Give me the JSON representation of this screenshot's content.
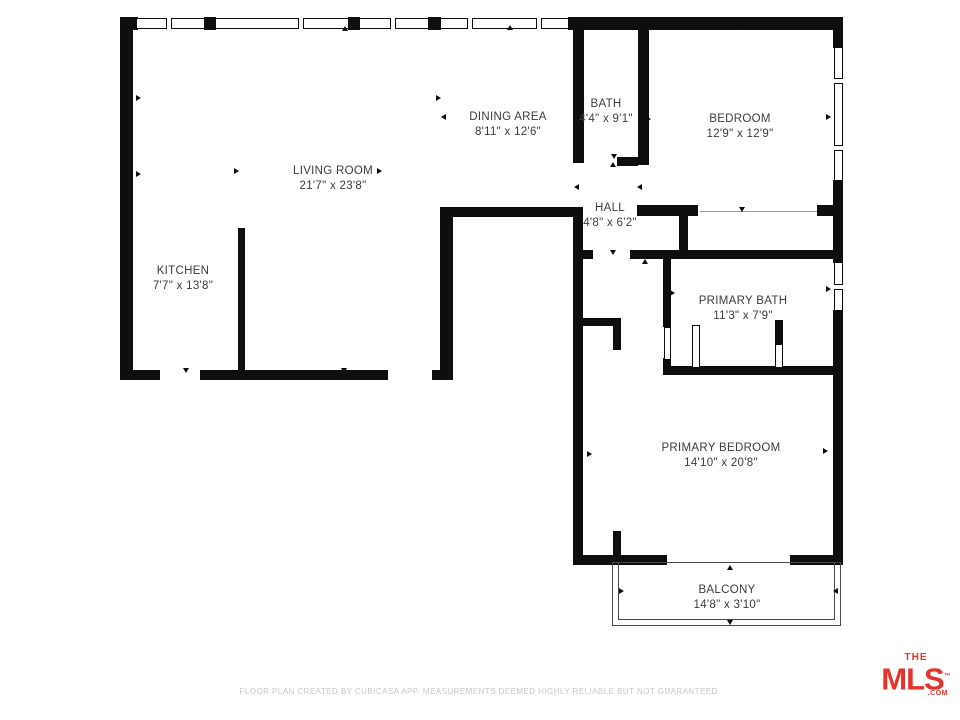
{
  "page": {
    "background": "#ffffff"
  },
  "rooms": [
    {
      "name": "LIVING ROOM",
      "dims": "21'7\" x 23'8\""
    },
    {
      "name": "DINING AREA",
      "dims": "8'11\" x 12'6\""
    },
    {
      "name": "BATH",
      "dims": "4'4\" x 9'1\""
    },
    {
      "name": "BEDROOM",
      "dims": "12'9\" x 12'9\""
    },
    {
      "name": "HALL",
      "dims": "4'8\" x 6'2\""
    },
    {
      "name": "KITCHEN",
      "dims": "7'7\" x 13'8\""
    },
    {
      "name": "PRIMARY BATH",
      "dims": "11'3\" x 7'9\""
    },
    {
      "name": "PRIMARY BEDROOM",
      "dims": "14'10\" x 20'8\""
    },
    {
      "name": "BALCONY",
      "dims": "14'8\" x 3'10\""
    }
  ],
  "footer": {
    "disclaimer": "FLOOR PLAN CREATED BY CUBICASA APP. MEASUREMENTS DEEMED HIGHLY RELIABLE BUT NOT GUARANTEED."
  },
  "logo": {
    "the": "THE",
    "mls": "MLS",
    "tm": "™",
    "com": ".COM",
    "color": "#e5342c"
  },
  "colors": {
    "wall": "#0e0e0e",
    "label_text": "#3c3c3c",
    "footer_text": "#c7c7c7"
  }
}
